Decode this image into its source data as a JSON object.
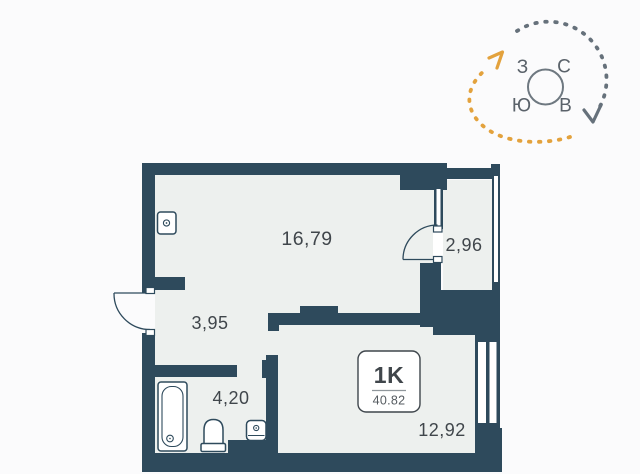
{
  "page": {
    "background": "#fbfbfc"
  },
  "plan": {
    "colors": {
      "wall": "#2e4a5c",
      "interior": "#edf0ee",
      "label": "#40464b",
      "badge_border": "#3f464c",
      "badge_divider": "#8f969b",
      "badge_area_text": "#555b60"
    },
    "rooms": {
      "living": {
        "area": "16,79"
      },
      "loggia": {
        "area": "2,96"
      },
      "hallway": {
        "area": "3,95"
      },
      "bathroom": {
        "area": "4,20"
      },
      "bedroom": {
        "area": "12,92"
      }
    },
    "badge": {
      "type": "1K",
      "total_area": "40.82"
    }
  },
  "compass": {
    "letters": {
      "west": "З",
      "north": "С",
      "south": "Ю",
      "east": "В"
    },
    "colors": {
      "ring": "#6e7880",
      "letter": "#5a626a",
      "arc_gray": "#66717b",
      "arc_orange": "#e3a23d"
    }
  }
}
